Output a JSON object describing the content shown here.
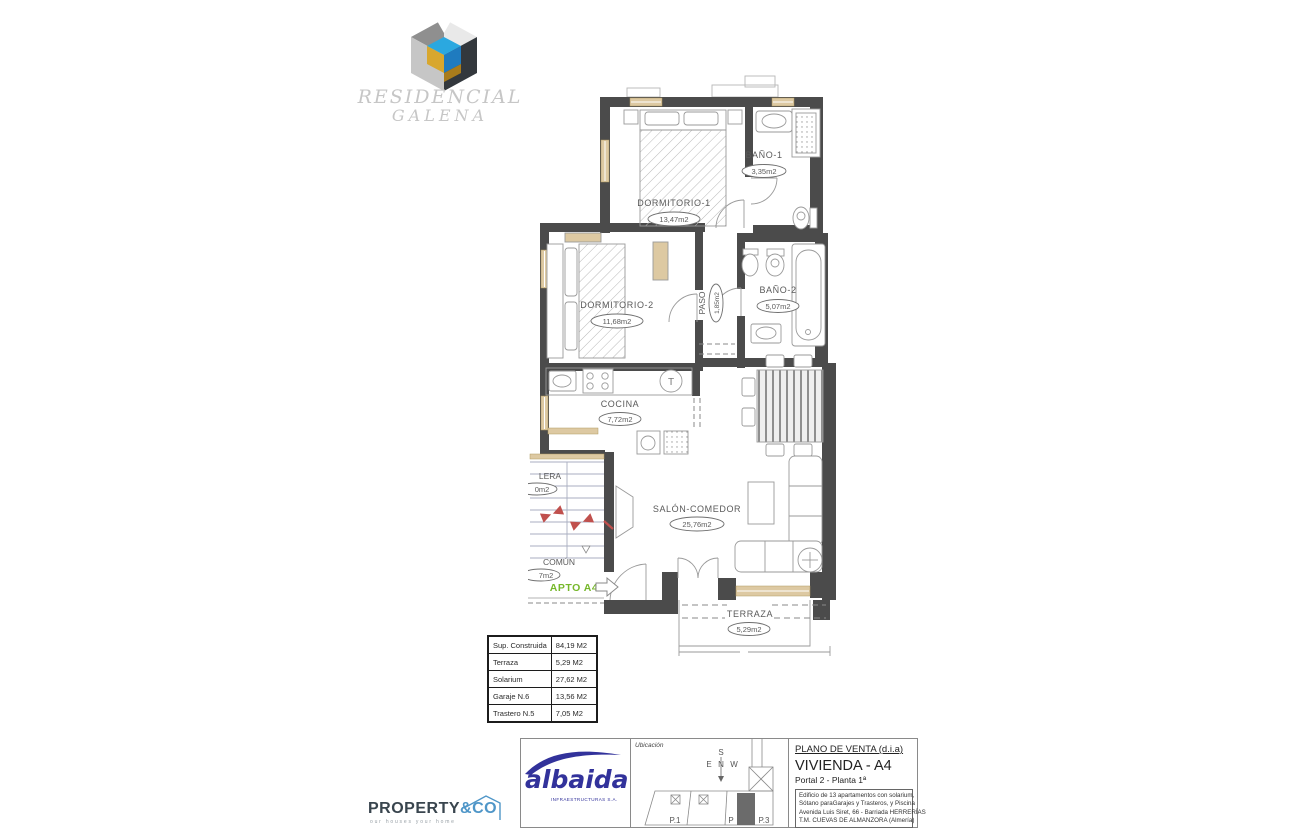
{
  "brand": {
    "line1": "RESIDENCIAL",
    "line2": "GALENA"
  },
  "floorplan": {
    "rooms": {
      "dormitorio1": {
        "name": "DORMITORIO-1",
        "area": "13,47m2"
      },
      "bano1": {
        "name": "BAÑO-1",
        "area": "3,35m2"
      },
      "dormitorio2": {
        "name": "DORMITORIO-2",
        "area": "11,68m2"
      },
      "bano2": {
        "name": "BAÑO-2",
        "area": "5,07m2"
      },
      "paso": {
        "name": "PASO",
        "area": "1,85m2"
      },
      "cocina": {
        "name": "COCINA",
        "area": "7,72m2"
      },
      "salon": {
        "name": "SALÓN-COMEDOR",
        "area": "25,76m2"
      },
      "terraza": {
        "name": "TERRAZA",
        "area": "5,29m2"
      },
      "escalera": {
        "name_clipped": "LERA",
        "area_clipped": "0m2"
      },
      "comun": {
        "name": "COMÚN",
        "area_clipped": "7m2"
      }
    },
    "apto_label": "APTO A4",
    "termo_symbol": "T"
  },
  "area_table": {
    "rows": [
      {
        "label": "Sup. Construida",
        "value": "84,19 M2"
      },
      {
        "label": "Terraza",
        "value": "5,29 M2"
      },
      {
        "label": "Solarium",
        "value": "27,62 M2"
      },
      {
        "label": "Garaje N.6",
        "value": "13,56 M2"
      },
      {
        "label": "Trastero N.5",
        "value": "7,05 M2"
      }
    ]
  },
  "title_block": {
    "albaida": {
      "wordmark": "albaida",
      "subtitle": "INFRAESTRUCTURAS S.A."
    },
    "ubicacion": {
      "label": "Ubicación",
      "compass": {
        "n": "N",
        "s": "S",
        "e": "E",
        "w": "W"
      },
      "plots": [
        "P.1",
        "P",
        "P.3"
      ]
    },
    "plan": {
      "doc_title": "PLANO DE VENTA (d.i.a)",
      "unit": "VIVIENDA - A4",
      "portal": "Portal 2 - Planta 1ª",
      "desc_lines": [
        "Edificio de 13 apartamentos con solarium,",
        "Sótano paraGarajes y Trasteros, y Piscina",
        "Avenida Luis Siret, 66 - Barriada HERRERÍAS",
        "T.M. CUEVAS DE ALMANZORA (Almería)"
      ]
    }
  },
  "property_logo": {
    "word": "PROPERTY",
    "suffix": "&CO",
    "tagline": "our houses your home"
  },
  "colors": {
    "wall": "#4b4b4b",
    "window": "#ddc9a2",
    "apto_green": "#76b82a",
    "stair_arrow_red": "#c0504d",
    "albaida_blue": "#32329b",
    "property_blue": "#4f96c8",
    "logo_blue": "#1f7bbf",
    "logo_blue_light": "#2ba8e0",
    "logo_gold": "#d8a72e"
  }
}
